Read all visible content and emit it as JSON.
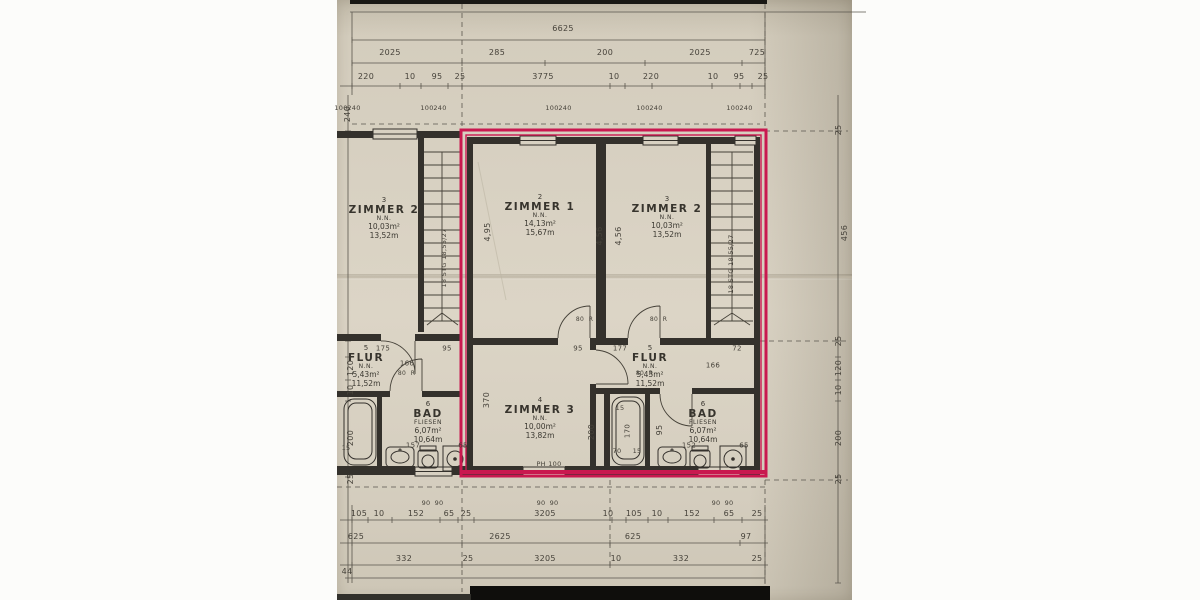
{
  "meta": {
    "description": "Photographed architectural floor plan (Grundriss) with one apartment unit outlined in red",
    "colors": {
      "paper": "#d8d1c2",
      "line": "#34312c",
      "dim_line": "#56524a",
      "red_outline": "#c9184f",
      "text": "#46423a"
    }
  },
  "rooms": {
    "z2_left": {
      "number": "3",
      "name": "ZIMMER 2",
      "sub": "N.N.",
      "area": "10,03m²",
      "perimeter": "13,52m"
    },
    "z1": {
      "number": "2",
      "name": "ZIMMER 1",
      "sub": "N.N.",
      "area": "14,13m²",
      "perimeter": "15,67m"
    },
    "z2_right": {
      "number": "3",
      "name": "ZIMMER 2",
      "sub": "N.N.",
      "area": "10,03m²",
      "perimeter": "13,52m"
    },
    "flur_left": {
      "number": "5",
      "name": "FLUR",
      "sub": "N.N.",
      "area": "5,43m²",
      "perimeter": "11,52m"
    },
    "flur_right": {
      "number": "5",
      "name": "FLUR",
      "sub": "N.N.",
      "area": "5,43m²",
      "perimeter": "11,52m"
    },
    "z3": {
      "number": "4",
      "name": "ZIMMER 3",
      "sub": "N.N.",
      "area": "10,00m²",
      "perimeter": "13,82m"
    },
    "bad_left": {
      "number": "6",
      "name": "BAD",
      "sub": "FLIESEN",
      "area": "6,07m²",
      "perimeter": "10,64m"
    },
    "bad_right": {
      "number": "6",
      "name": "BAD",
      "sub": "FLIESEN",
      "area": "6,07m²",
      "perimeter": "10,64m"
    }
  },
  "labels": [
    {
      "t": "6625",
      "x": 563,
      "y": 29
    },
    {
      "t": "2025",
      "x": 390,
      "y": 53
    },
    {
      "t": "285",
      "x": 497,
      "y": 53
    },
    {
      "t": "200",
      "x": 605,
      "y": 53
    },
    {
      "t": "2025",
      "x": 700,
      "y": 53
    },
    {
      "t": "725",
      "x": 757,
      "y": 53
    },
    {
      "t": "220",
      "x": 366,
      "y": 77
    },
    {
      "t": "10",
      "x": 410,
      "y": 77
    },
    {
      "t": "95",
      "x": 437,
      "y": 77
    },
    {
      "t": "25",
      "x": 460,
      "y": 77
    },
    {
      "t": "3775",
      "x": 543,
      "y": 77
    },
    {
      "t": "10",
      "x": 614,
      "y": 77
    },
    {
      "t": "220",
      "x": 651,
      "y": 77
    },
    {
      "t": "10",
      "x": 713,
      "y": 77
    },
    {
      "t": "95",
      "x": 739,
      "y": 77
    },
    {
      "t": "25",
      "x": 763,
      "y": 77
    },
    {
      "t": "100",
      "x": 341,
      "y": 108,
      "s": 6.5
    },
    {
      "t": "240",
      "x": 354,
      "y": 108,
      "s": 6.5
    },
    {
      "t": "100",
      "x": 427,
      "y": 108,
      "s": 6.5
    },
    {
      "t": "240",
      "x": 440,
      "y": 108,
      "s": 6.5
    },
    {
      "t": "100",
      "x": 552,
      "y": 108,
      "s": 6.5
    },
    {
      "t": "240",
      "x": 565,
      "y": 108,
      "s": 6.5
    },
    {
      "t": "100",
      "x": 643,
      "y": 108,
      "s": 6.5
    },
    {
      "t": "240",
      "x": 656,
      "y": 108,
      "s": 6.5
    },
    {
      "t": "100",
      "x": 733,
      "y": 108,
      "s": 6.5
    },
    {
      "t": "240",
      "x": 746,
      "y": 108,
      "s": 6.5
    },
    {
      "t": "240",
      "x": 348,
      "y": 114,
      "r": -90
    },
    {
      "t": "120",
      "x": 351,
      "y": 368,
      "r": -90
    },
    {
      "t": "10",
      "x": 351,
      "y": 390,
      "r": -90
    },
    {
      "t": "200",
      "x": 351,
      "y": 438,
      "r": -90
    },
    {
      "t": "25",
      "x": 351,
      "y": 479,
      "r": -90
    },
    {
      "t": "25",
      "x": 839,
      "y": 130,
      "r": -90
    },
    {
      "t": "456",
      "x": 845,
      "y": 233,
      "r": -90
    },
    {
      "t": "25",
      "x": 839,
      "y": 341,
      "r": -90
    },
    {
      "t": "120",
      "x": 839,
      "y": 368,
      "r": -90
    },
    {
      "t": "10",
      "x": 839,
      "y": 390,
      "r": -90
    },
    {
      "t": "200",
      "x": 839,
      "y": 438,
      "r": -90
    },
    {
      "t": "25",
      "x": 839,
      "y": 479,
      "r": -90
    },
    {
      "t": "4,95",
      "x": 488,
      "y": 232,
      "r": -90
    },
    {
      "t": "4,56",
      "x": 600,
      "y": 236,
      "r": -90
    },
    {
      "t": "4,56",
      "x": 619,
      "y": 236,
      "r": -90
    },
    {
      "t": "370",
      "x": 487,
      "y": 400,
      "r": -90
    },
    {
      "t": "200",
      "x": 592,
      "y": 432,
      "r": -90
    },
    {
      "t": "170",
      "x": 628,
      "y": 431,
      "r": -90,
      "s": 7
    },
    {
      "t": "95",
      "x": 660,
      "y": 430,
      "r": -90
    },
    {
      "t": "18 STG 18,55/27",
      "x": 444,
      "y": 258,
      "r": -90,
      "s": 6.5
    },
    {
      "t": "18 STG 18,55/27",
      "x": 731,
      "y": 264,
      "r": -90,
      "s": 6.5
    },
    {
      "t": "175",
      "x": 383,
      "y": 349,
      "s": 7
    },
    {
      "t": "95",
      "x": 447,
      "y": 349,
      "s": 7
    },
    {
      "t": "166",
      "x": 407,
      "y": 364,
      "s": 7
    },
    {
      "t": "80",
      "x": 402,
      "y": 374,
      "s": 6
    },
    {
      "t": "R",
      "x": 413,
      "y": 374,
      "s": 6
    },
    {
      "t": "95",
      "x": 578,
      "y": 349,
      "s": 7
    },
    {
      "t": "177",
      "x": 620,
      "y": 349,
      "s": 7
    },
    {
      "t": "72",
      "x": 737,
      "y": 349,
      "s": 7
    },
    {
      "t": "166",
      "x": 713,
      "y": 366,
      "s": 7
    },
    {
      "t": "80",
      "x": 640,
      "y": 374,
      "s": 6
    },
    {
      "t": "R",
      "x": 651,
      "y": 374,
      "s": 6
    },
    {
      "t": "80",
      "x": 580,
      "y": 320,
      "s": 6
    },
    {
      "t": "R",
      "x": 591,
      "y": 320,
      "s": 6
    },
    {
      "t": "80",
      "x": 654,
      "y": 320,
      "s": 6
    },
    {
      "t": "R",
      "x": 665,
      "y": 320,
      "s": 6
    },
    {
      "t": "15",
      "x": 620,
      "y": 408,
      "s": 6.5
    },
    {
      "t": "70",
      "x": 617,
      "y": 451,
      "s": 6.5
    },
    {
      "t": "15",
      "x": 637,
      "y": 451,
      "s": 6.5
    },
    {
      "t": "152",
      "x": 689,
      "y": 446,
      "s": 7
    },
    {
      "t": "65",
      "x": 744,
      "y": 446,
      "s": 7
    },
    {
      "t": "157",
      "x": 413,
      "y": 446,
      "s": 7
    },
    {
      "t": "65",
      "x": 463,
      "y": 446,
      "s": 7
    },
    {
      "t": "15",
      "x": 346,
      "y": 448,
      "s": 6.5
    },
    {
      "t": "PH 100",
      "x": 549,
      "y": 464,
      "s": 6.5
    },
    {
      "t": "90",
      "x": 426,
      "y": 503,
      "s": 6.5
    },
    {
      "t": "90",
      "x": 439,
      "y": 503,
      "s": 6.5
    },
    {
      "t": "90",
      "x": 541,
      "y": 503,
      "s": 6.5
    },
    {
      "t": "90",
      "x": 554,
      "y": 503,
      "s": 6.5
    },
    {
      "t": "90",
      "x": 716,
      "y": 503,
      "s": 6.5
    },
    {
      "t": "90",
      "x": 729,
      "y": 503,
      "s": 6.5
    },
    {
      "t": "105",
      "x": 359,
      "y": 514
    },
    {
      "t": "10",
      "x": 379,
      "y": 514
    },
    {
      "t": "152",
      "x": 416,
      "y": 514
    },
    {
      "t": "65",
      "x": 449,
      "y": 514
    },
    {
      "t": "25",
      "x": 466,
      "y": 514
    },
    {
      "t": "3205",
      "x": 545,
      "y": 514
    },
    {
      "t": "10",
      "x": 608,
      "y": 514
    },
    {
      "t": "105",
      "x": 634,
      "y": 514
    },
    {
      "t": "10",
      "x": 657,
      "y": 514
    },
    {
      "t": "152",
      "x": 692,
      "y": 514
    },
    {
      "t": "65",
      "x": 729,
      "y": 514
    },
    {
      "t": "25",
      "x": 757,
      "y": 514
    },
    {
      "t": "625",
      "x": 356,
      "y": 537
    },
    {
      "t": "2625",
      "x": 500,
      "y": 537
    },
    {
      "t": "625",
      "x": 633,
      "y": 537
    },
    {
      "t": "97",
      "x": 746,
      "y": 537
    },
    {
      "t": "332",
      "x": 404,
      "y": 559
    },
    {
      "t": "25",
      "x": 468,
      "y": 559
    },
    {
      "t": "3205",
      "x": 545,
      "y": 559
    },
    {
      "t": "10",
      "x": 616,
      "y": 559
    },
    {
      "t": "332",
      "x": 681,
      "y": 559
    },
    {
      "t": "25",
      "x": 757,
      "y": 559
    },
    {
      "t": "44",
      "x": 347,
      "y": 572
    }
  ]
}
